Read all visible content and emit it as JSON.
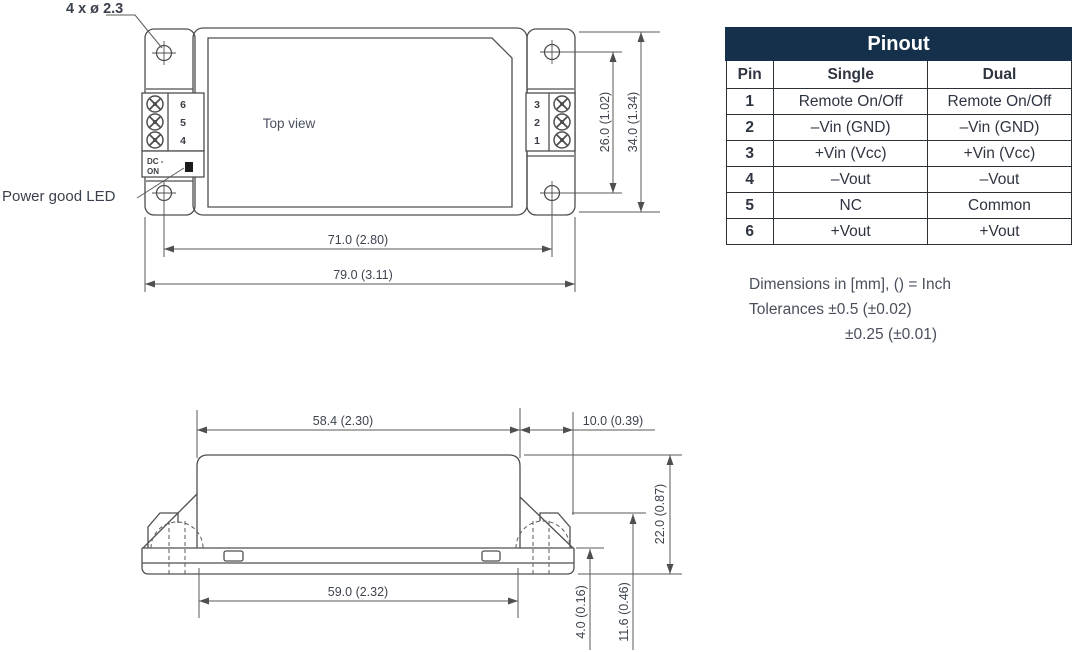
{
  "annotations": {
    "hole_callout": "4 x ø 2.3",
    "power_good_led": "Power good LED",
    "top_view_label": "Top view",
    "dc_line1": "DC -",
    "dc_line2": "ON"
  },
  "top_view": {
    "left_terminals": [
      "6",
      "5",
      "4"
    ],
    "right_terminals": [
      "3",
      "2",
      "1"
    ],
    "dim_hole_spacing_x": "71.0 (2.80)",
    "dim_overall_width": "79.0 (3.11)",
    "dim_hole_spacing_y": "26.0 (1.02)",
    "dim_overall_height": "34.0 (1.34)"
  },
  "side_view": {
    "dim_body_width": "58.4 (2.30)",
    "dim_flange_ext": "10.0 (0.39)",
    "dim_height": "22.0 (0.87)",
    "dim_base_width": "59.0 (2.32)",
    "dim_standoff": "4.0 (0.16)",
    "dim_bracket_height": "11.6 (0.46)"
  },
  "pinout": {
    "title": "Pinout",
    "columns": [
      "Pin",
      "Single",
      "Dual"
    ],
    "rows": [
      {
        "pin": "1",
        "single": "Remote On/Off",
        "dual": "Remote On/Off"
      },
      {
        "pin": "2",
        "single": "–Vin (GND)",
        "dual": "–Vin (GND)"
      },
      {
        "pin": "3",
        "single": "+Vin (Vcc)",
        "dual": "+Vin (Vcc)"
      },
      {
        "pin": "4",
        "single": "–Vout",
        "dual": "–Vout"
      },
      {
        "pin": "5",
        "single": "NC",
        "dual": "Common"
      },
      {
        "pin": "6",
        "single": "+Vout",
        "dual": "+Vout"
      }
    ]
  },
  "notes": {
    "line1": "Dimensions in [mm], () = Inch",
    "line2": "Tolerances  ±0.5 (±0.02)",
    "line3": "±0.25 (±0.01)"
  },
  "colors": {
    "header_bg": "#14304a",
    "header_text": "#ffffff",
    "line": "#4f4f4f",
    "text": "#3d434e",
    "led": "#1c1c1c"
  }
}
